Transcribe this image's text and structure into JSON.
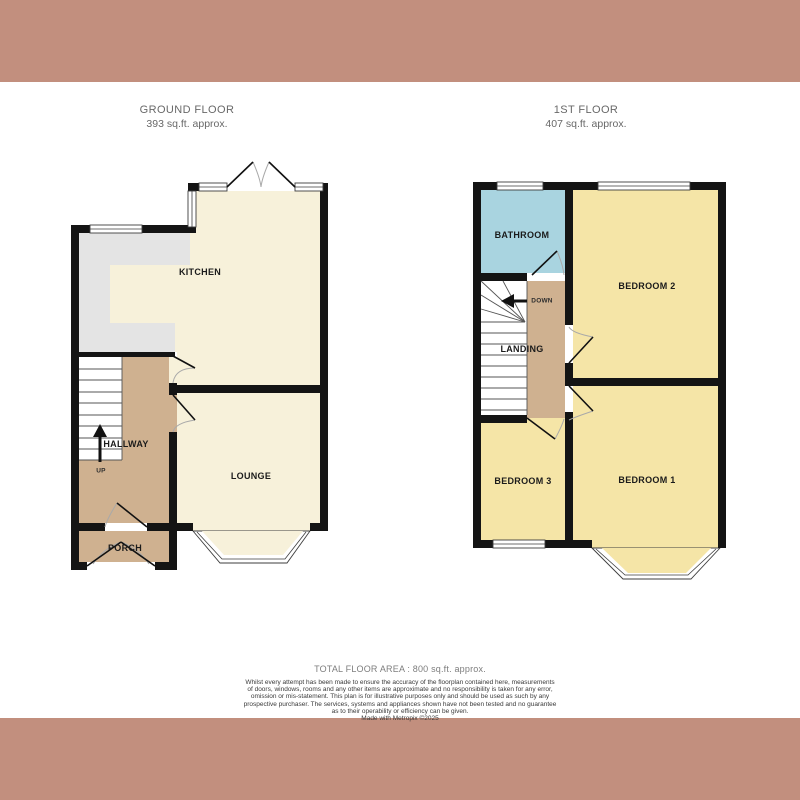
{
  "colors": {
    "band": "#c28f7e",
    "wall": "#141414",
    "cream": "#f7f1da",
    "yellow": "#f5e5a7",
    "blue": "#a9d4e0",
    "tan": "#cfb190",
    "counter": "#e4e4e4"
  },
  "floors": [
    {
      "title": "GROUND FLOOR",
      "area": "393 sq.ft. approx.",
      "stairs_label": "UP",
      "rooms": [
        {
          "name": "KITCHEN"
        },
        {
          "name": "HALLWAY"
        },
        {
          "name": "LOUNGE"
        },
        {
          "name": "PORCH"
        }
      ]
    },
    {
      "title": "1ST FLOOR",
      "area": "407 sq.ft. approx.",
      "stairs_label": "DOWN",
      "rooms": [
        {
          "name": "BATHROOM"
        },
        {
          "name": "BEDROOM 2"
        },
        {
          "name": "LANDING"
        },
        {
          "name": "BEDROOM 3"
        },
        {
          "name": "BEDROOM 1"
        }
      ]
    }
  ],
  "footer": {
    "total": "TOTAL FLOOR AREA : 800 sq.ft. approx.",
    "lines": [
      "Whilst every attempt has been made to ensure the accuracy of the floorplan contained here, measurements",
      "of doors, windows, rooms and any other items are approximate and no responsibility is taken for any error,",
      "omission or mis-statement. This plan is for illustrative purposes only and should be used as such by any",
      "prospective purchaser. The services, systems and appliances shown have not been tested and no guarantee",
      "as to their operability or efficiency can be given."
    ],
    "credit": "Made with Metropix ©2025"
  }
}
